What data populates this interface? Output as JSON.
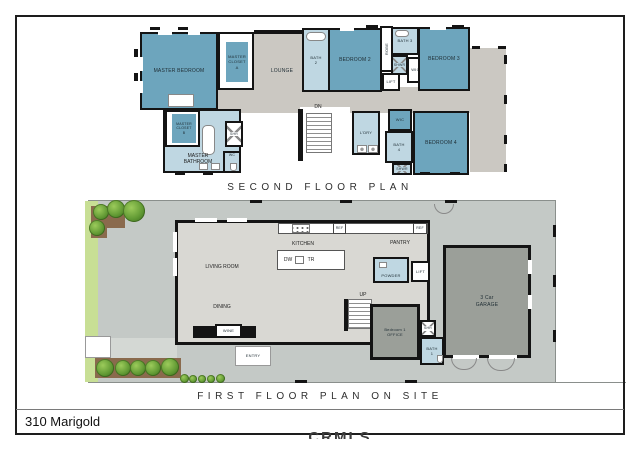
{
  "page": {
    "address": "310 Marigold",
    "watermark": "CRMLS"
  },
  "titles": {
    "second": "SECOND FLOOR PLAN",
    "first": "FIRST FLOOR PLAN ON SITE"
  },
  "second_floor": {
    "master_bedroom": "MASTER BEDROOM",
    "master_closet_a": "MASTER\nCLOSET\nA",
    "lounge": "LOUNGE",
    "bath_2": "BATH\n2",
    "bedroom_2": "BEDROOM 2",
    "robe": "ROBE",
    "bath_3": "BATH 3",
    "shwr_upper": "SHWR",
    "wic_upper": "WIC",
    "lift": "LIFT",
    "bedroom_3": "BEDROOM 3",
    "dn": "DN",
    "laundry": "L'DRY",
    "wic_lower": "WIC",
    "bath_4": "BATH\n4",
    "shwr_lower": "SHWR",
    "bedroom_4": "BEDROOM 4",
    "master_closet_b": "MASTER\nCLOSET\nB",
    "master_bathroom": "MASTER\nBATHROOM",
    "shr": "SHR",
    "wc": "WC"
  },
  "first_floor": {
    "kitchen": "KITCHEN",
    "dw": "DW",
    "tr": "TR",
    "ref_left": "REF",
    "ref_right": "REF",
    "pantry": "PANTRY",
    "powder": "POWDER",
    "lift": "LIFT",
    "up": "UP",
    "living_room": "LIVING ROOM",
    "dining": "DINING",
    "wine": "WINE",
    "entry": "ENTRY",
    "bedroom_1_office": "Bedroom 1\nOFFICE",
    "shr": "SHR",
    "bath_1": "BATH\n1",
    "garage": "3 Car\nGARAGE"
  },
  "colors": {
    "bedroom_fill": "#6DA5BD",
    "bathroom_fill": "#BFD7E2",
    "hall_fill": "#CBC8C2",
    "interior_fill": "#D9D8D3",
    "garage_fill": "#9B9F99",
    "site_fill": "#C4C9C6",
    "lawn_green": "#C8DF95",
    "planter_brown": "#8A6A4D",
    "wall": "#141414"
  }
}
